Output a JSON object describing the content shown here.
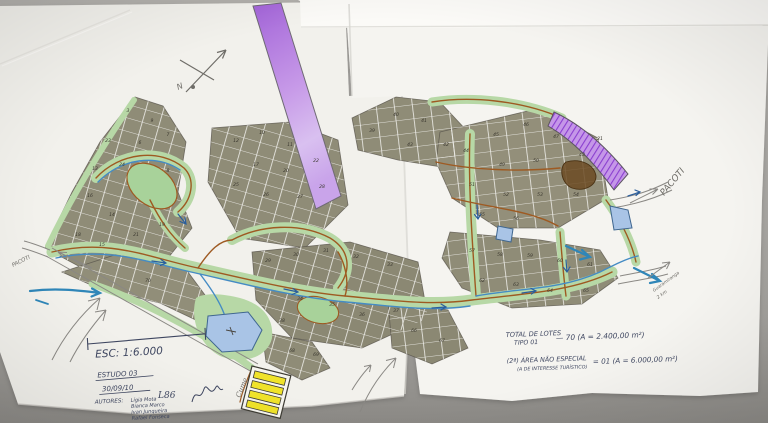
{
  "title": "Croqui de loteamento - Estudo 03",
  "labels": {
    "north": "N",
    "pacoti_left": "PACOTI",
    "pacoti_right": "PACOTI",
    "guaramiranga_1": "Guaramiranga",
    "guaramiranga_2": "2 km",
    "cume": "Cume"
  },
  "title_block": {
    "scale": "ESC: 1:6.000",
    "study": "ESTUDO 03",
    "date": "30/09/10",
    "authors_label": "AUTORES:",
    "authors": [
      "Lígia Mota",
      "Bianca Marco",
      "Ivan Junqueira",
      "Rafael Fonseca"
    ],
    "initials": "L86"
  },
  "totals": {
    "line1_label": "TOTAL DE LOTES",
    "line1_sub": "TIPO 01",
    "line1_value": "— 70 (A = 2.400,00 m²)",
    "line2_label": "(2ª) ÁREA NÃO ESPECIAL",
    "line2_sub": "(A DE INTERESSE TURÍSTICO)",
    "line2_value": "= 01 (A = 6.000,00 m²)"
  },
  "map": {
    "colors": {
      "surface": "#a9a7a3",
      "paper": "#f2f1ec",
      "paper_bright": "#fbfaf7",
      "lot": "#8f8c77",
      "green": "#b7d8a6",
      "green_dark": "#a8d29a",
      "road": "#9e5a22",
      "stream": "#448bc4",
      "teal": "#2f86b8",
      "purple": "#b87ae0",
      "purple_dark": "#8b3fd0",
      "pond": "#a9c4e6",
      "yellow": "#f0e32a",
      "ink": "#3e4660",
      "pencil": "#6f6d68",
      "pen": "#55514a"
    },
    "lots": [
      {
        "n": "3",
        "x": 128,
        "y": 112
      },
      {
        "n": "9",
        "x": 152,
        "y": 122
      },
      {
        "n": "23",
        "x": 108,
        "y": 142
      },
      {
        "n": "6",
        "x": 140,
        "y": 144
      },
      {
        "n": "7",
        "x": 168,
        "y": 136
      },
      {
        "n": "13",
        "x": 95,
        "y": 170
      },
      {
        "n": "24",
        "x": 122,
        "y": 166
      },
      {
        "n": "8",
        "x": 168,
        "y": 172
      },
      {
        "n": "16",
        "x": 90,
        "y": 197
      },
      {
        "n": "14",
        "x": 112,
        "y": 216
      },
      {
        "n": "18",
        "x": 78,
        "y": 236
      },
      {
        "n": "15",
        "x": 102,
        "y": 246
      },
      {
        "n": "21",
        "x": 136,
        "y": 236
      },
      {
        "n": "19",
        "x": 162,
        "y": 226
      },
      {
        "n": "12",
        "x": 236,
        "y": 142
      },
      {
        "n": "10",
        "x": 262,
        "y": 134
      },
      {
        "n": "11",
        "x": 290,
        "y": 146
      },
      {
        "n": "17",
        "x": 256,
        "y": 166
      },
      {
        "n": "20",
        "x": 286,
        "y": 172
      },
      {
        "n": "22",
        "x": 316,
        "y": 162
      },
      {
        "n": "25",
        "x": 236,
        "y": 186
      },
      {
        "n": "26",
        "x": 266,
        "y": 196
      },
      {
        "n": "27",
        "x": 300,
        "y": 198
      },
      {
        "n": "28",
        "x": 322,
        "y": 188
      },
      {
        "n": "29",
        "x": 268,
        "y": 262
      },
      {
        "n": "30",
        "x": 296,
        "y": 256
      },
      {
        "n": "31",
        "x": 326,
        "y": 252
      },
      {
        "n": "32",
        "x": 356,
        "y": 258
      },
      {
        "n": "33",
        "x": 390,
        "y": 266
      },
      {
        "n": "34",
        "x": 300,
        "y": 300
      },
      {
        "n": "35",
        "x": 332,
        "y": 306
      },
      {
        "n": "36",
        "x": 362,
        "y": 316
      },
      {
        "n": "37",
        "x": 396,
        "y": 312
      },
      {
        "n": "38",
        "x": 282,
        "y": 322
      },
      {
        "n": "39",
        "x": 372,
        "y": 132
      },
      {
        "n": "40",
        "x": 396,
        "y": 116
      },
      {
        "n": "41",
        "x": 424,
        "y": 122
      },
      {
        "n": "42",
        "x": 446,
        "y": 146
      },
      {
        "n": "43",
        "x": 410,
        "y": 146
      },
      {
        "n": "44",
        "x": 466,
        "y": 152
      },
      {
        "n": "45",
        "x": 496,
        "y": 136
      },
      {
        "n": "46",
        "x": 526,
        "y": 126
      },
      {
        "n": "47",
        "x": 556,
        "y": 138
      },
      {
        "n": "48",
        "x": 582,
        "y": 156
      },
      {
        "n": "49",
        "x": 502,
        "y": 166
      },
      {
        "n": "50",
        "x": 536,
        "y": 162
      },
      {
        "n": "51",
        "x": 472,
        "y": 186
      },
      {
        "n": "52",
        "x": 506,
        "y": 196
      },
      {
        "n": "53",
        "x": 540,
        "y": 196
      },
      {
        "n": "54",
        "x": 576,
        "y": 196
      },
      {
        "n": "55",
        "x": 482,
        "y": 216
      },
      {
        "n": "56",
        "x": 516,
        "y": 220
      },
      {
        "n": "57",
        "x": 472,
        "y": 252
      },
      {
        "n": "58",
        "x": 500,
        "y": 256
      },
      {
        "n": "59",
        "x": 530,
        "y": 257
      },
      {
        "n": "60",
        "x": 560,
        "y": 262
      },
      {
        "n": "61",
        "x": 590,
        "y": 266
      },
      {
        "n": "62",
        "x": 482,
        "y": 282
      },
      {
        "n": "63",
        "x": 516,
        "y": 286
      },
      {
        "n": "64",
        "x": 550,
        "y": 292
      },
      {
        "n": "65",
        "x": 586,
        "y": 292
      },
      {
        "n": "66",
        "x": 414,
        "y": 332
      },
      {
        "n": "67",
        "x": 442,
        "y": 342
      },
      {
        "n": "68",
        "x": 292,
        "y": 352
      },
      {
        "n": "69",
        "x": 316,
        "y": 356
      },
      {
        "n": "70",
        "x": 148,
        "y": 282
      },
      {
        "n": "21",
        "x": 600,
        "y": 140
      }
    ]
  }
}
